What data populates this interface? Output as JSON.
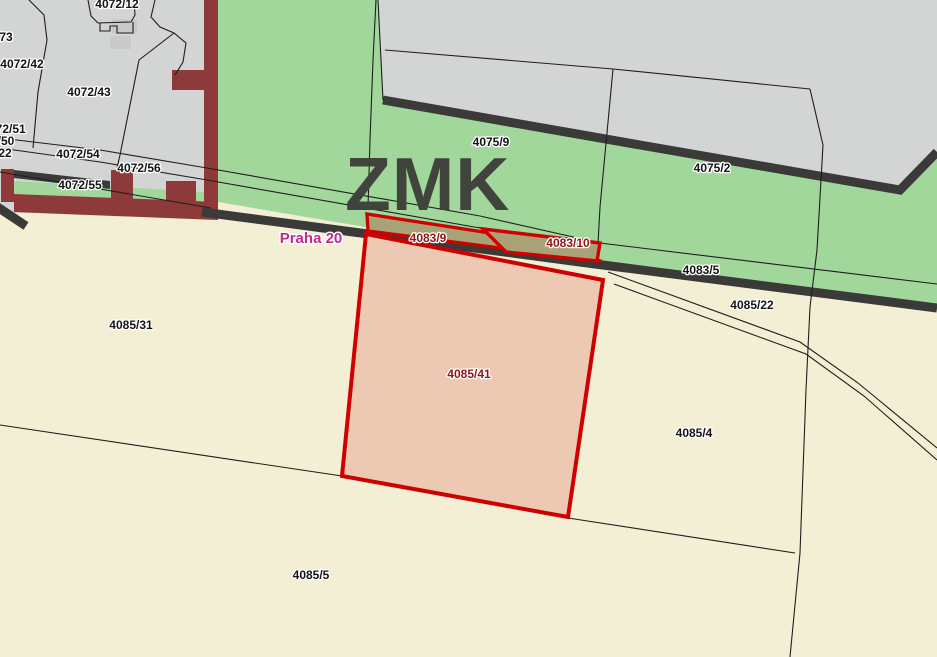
{
  "map": {
    "title": "Cadastral zoning map view",
    "zone_label": {
      "text": "ZMK"
    },
    "municipality_label": {
      "text": "Praha 20"
    },
    "highlighted_parcels": [
      "4083/9",
      "4083/10",
      "4085/41"
    ],
    "parcel_labels": [
      {
        "text": "4072/12"
      },
      {
        "text": "73"
      },
      {
        "text": "4072/42"
      },
      {
        "text": "4072/43"
      },
      {
        "text": "4072/51"
      },
      {
        "text": "/50"
      },
      {
        "text": "22"
      },
      {
        "text": "4072/54"
      },
      {
        "text": "4072/56"
      },
      {
        "text": "4072/55"
      },
      {
        "text": "4075/9"
      },
      {
        "text": "4075/2"
      },
      {
        "text": "4083/9"
      },
      {
        "text": "4083/10"
      },
      {
        "text": "4083/5"
      },
      {
        "text": "4085/22"
      },
      {
        "text": "4085/31"
      },
      {
        "text": "4085/41"
      },
      {
        "text": "4085/4"
      },
      {
        "text": "4085/5"
      }
    ],
    "colors": {
      "field_cream": "#f2efd5",
      "greenery_zmk": "#a2d79c",
      "built_gray": "#d2d5d3",
      "structure_maroon": "#8e3a3a",
      "road_dark": "#3a3a38",
      "highlight_red": "#cf0000",
      "highlight_fill_salmon": "#edc9b4",
      "highlight_fill_olive": "#a9a276",
      "municipality_magenta": "#c12a8c",
      "zone_text_gray": "#40443c"
    }
  }
}
